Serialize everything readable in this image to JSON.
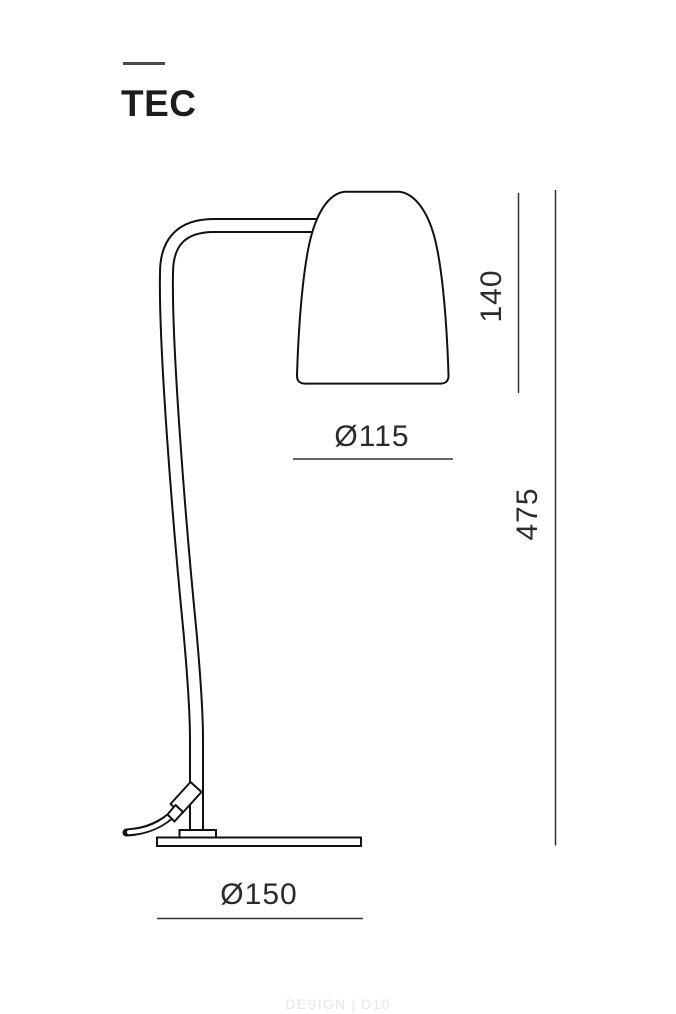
{
  "header": {
    "title": "TEC"
  },
  "dimensions": {
    "shade_height_label": "140",
    "total_height_label": "475",
    "shade_diameter_label": "Ø115",
    "base_diameter_label": "Ø150"
  },
  "footer": {
    "credit": "DESIGN | D10"
  },
  "colors": {
    "background": "#ffffff",
    "drawing_line": "#111111",
    "dimension_line": "#333333",
    "dimension_text": "#2b2b2b",
    "title_text": "#1d1d1f",
    "title_tick": "#4a4a4a",
    "footer_text": "#ebe6e1"
  }
}
